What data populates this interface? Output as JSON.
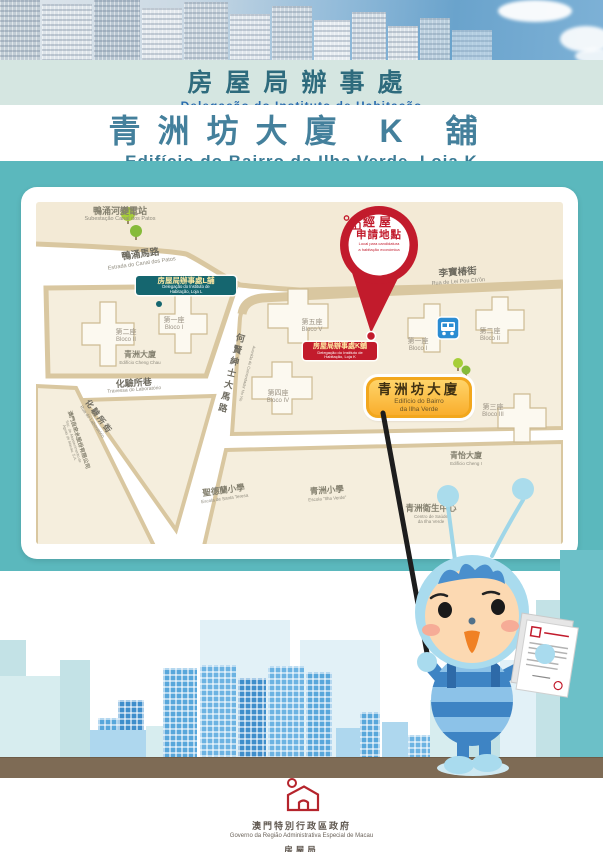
{
  "header": {
    "band1_zh": "房屋局辦事處",
    "band1_pt": "Delegação do Instituto de Habitação",
    "band2_zh": "青洲坊大廈 K 舖",
    "band2_pt": "Edifício do Bairro da Ilha Verde, Loja K"
  },
  "map": {
    "substation": {
      "zh": "鴨涌河變電站",
      "pt": "Subestação Canal dos Patos"
    },
    "street_canal": {
      "zh": "鴨涌馬路",
      "pt": "Estrada do Canal dos Patos"
    },
    "street_leipou": {
      "zh": "李寶椿街",
      "pt": "Rua de Lei Pou Ch'ôn"
    },
    "street_trav_lab": {
      "zh": "化驗所巷",
      "pt": "Travessa do Laboratório"
    },
    "street_rua_lab": {
      "zh": "化驗所街",
      "pt": "Rua do Laboratório"
    },
    "street_hoyin": {
      "zh": "何賢紳士大馬路",
      "pt": "Avenida do Comendador Ho Yin"
    },
    "water_co": {
      "zh": "澳門自來水股份有限公司",
      "pt1": "Soc. de Abastecimento de",
      "pt2": "Águas de Macau, S.A."
    },
    "ed_cheng_chau": {
      "zh": "青洲大廈",
      "pt": "Edifício Cheng Chau"
    },
    "ed_cheng_i": {
      "zh": "青怡大廈",
      "pt": "Edifício Cheng I"
    },
    "health_centre": {
      "zh": "青洲衛生中心",
      "pt1": "Centro de Saúde",
      "pt2": "da Ilha Verde"
    },
    "school_ilha": {
      "zh": "青洲小學",
      "pt": "Escola \"Ilha Verde\""
    },
    "school_teresa": {
      "zh": "聖德蘭小學",
      "pt": "Escola de Santa Teresa"
    },
    "left_b1": {
      "zh": "第一座",
      "pt": "Bloco I"
    },
    "left_b2": {
      "zh": "第二座",
      "pt": "Bloco II"
    },
    "right_b1": {
      "zh": "第一座",
      "pt": "Bloco I"
    },
    "right_b2": {
      "zh": "第二座",
      "pt": "Bloco II"
    },
    "right_b3": {
      "zh": "第三座",
      "pt": "Bloco III"
    },
    "right_b4": {
      "zh": "第四座",
      "pt": "Bloco IV"
    },
    "right_b5": {
      "zh": "第五座",
      "pt": "Bloco V"
    },
    "label_loja_l": {
      "zh": "房屋局辦事處L舖",
      "pt1": "Delegação do Instituto de",
      "pt2": "Habitação, Loja L"
    },
    "label_loja_k": {
      "zh": "房屋局辦事處K舖",
      "pt1": "Delegação do Instituto de",
      "pt2": "Habitação, Loja K"
    },
    "label_building": {
      "zh": "青洲坊大廈",
      "pt1": "Edifício do Bairro",
      "pt2": "da Ilha Verde"
    },
    "pin": {
      "zh1": "經屋",
      "zh2": "申請地點",
      "pt1": "Local para candidatura",
      "pt2": "a habitação económica"
    }
  },
  "footer": {
    "gov_zh": "澳門特別行政區政府",
    "gov_pt": "Governo da Região Administrativa Especial de Macau",
    "ih_zh": "房屋局",
    "ih_pt": "Instituto de Habitação"
  },
  "icons": {
    "pin_house": "house-icon",
    "bus": "bus-icon",
    "trees": "tree-icon",
    "footer_logo": "ih-house-logo"
  },
  "colors": {
    "teal_bg": "#5bb8bd",
    "label_teal": "#15666f",
    "label_red": "#c21b2c",
    "label_yellow": "#f9b233",
    "ground_brown": "#7e6b55"
  }
}
